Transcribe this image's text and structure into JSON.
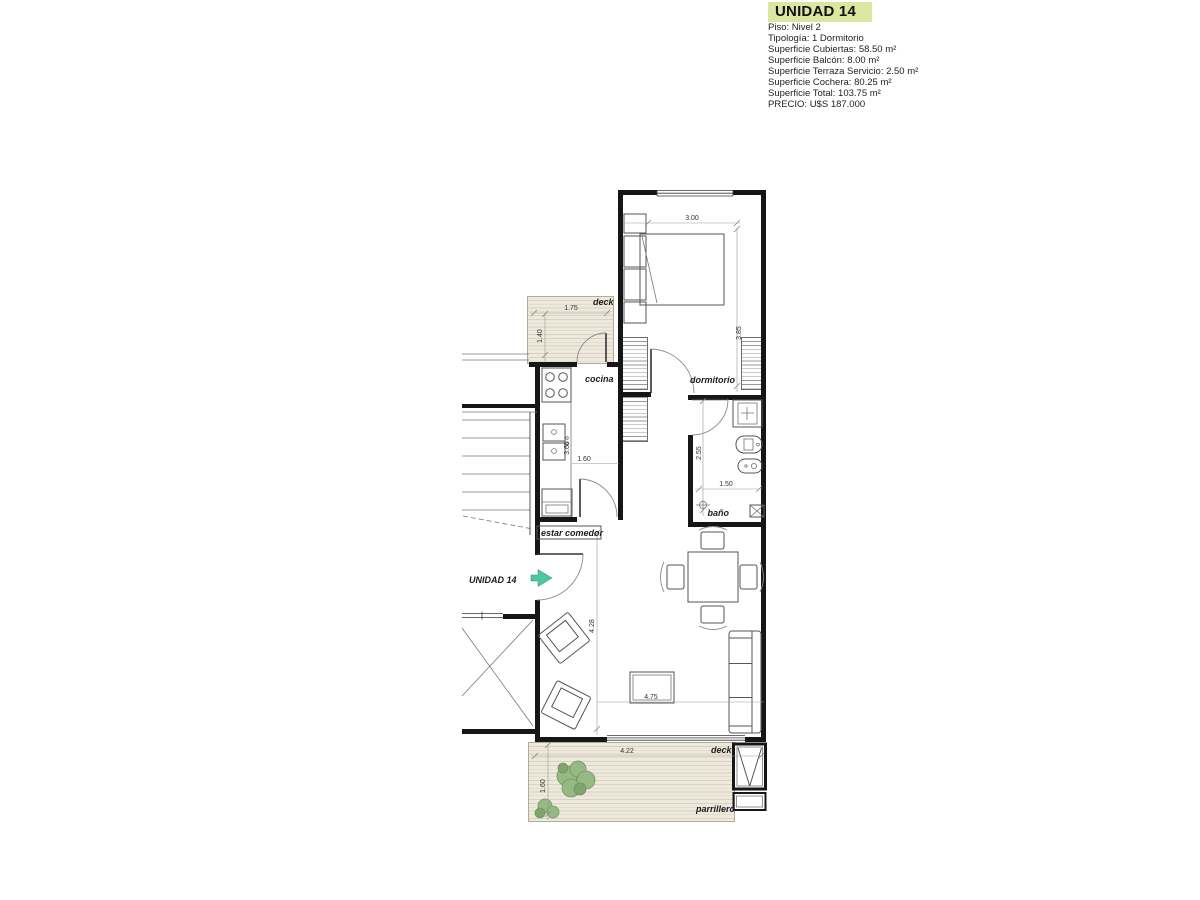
{
  "info_panel": {
    "title": "UNIDAD 14",
    "piso": "Piso: Nivel 2",
    "tipologia": "Tipología: 1 Dormitorio",
    "sup_cubiertas": "Superficie Cubiertas: 58.50 m²",
    "sup_balcon": "Superficie Balcón: 8.00 m²",
    "sup_terraza": "Superficie Terraza Servicio: 2.50 m²",
    "sup_cochera": "Superficie Cochera: 80.25 m²",
    "sup_total": "Superficie Total: 103.75 m²",
    "precio": "PRECIO: U$S 187.000"
  },
  "plan": {
    "labels": {
      "dormitorio": "dormitorio",
      "cocina": "cocina",
      "bano": "baño",
      "estar": "estar comedor",
      "deck_top": "deck",
      "deck_bottom": "deck",
      "parrillero": "parrillero",
      "unidad_arrow": "UNIDAD 14"
    },
    "dims": {
      "dorm_w": "3.00",
      "dorm_h": "3.85",
      "deck_top_w": "1.75",
      "deck_top_h": "1.40",
      "kitchen_w": "1.60",
      "kitchen_h": "3.60",
      "bath_h": "2.55",
      "bath_w": "1.50",
      "living_h": "4.28",
      "living_w": "4.75",
      "deck_bottom_w": "4.22",
      "deck_bottom_h": "1.60"
    },
    "colors": {
      "title_highlight": "#d9e7a0",
      "arrow_green": "#4fc69e",
      "deck_fill": "#ece7da",
      "plant_green": "#96b885",
      "wall": "#161616"
    }
  }
}
